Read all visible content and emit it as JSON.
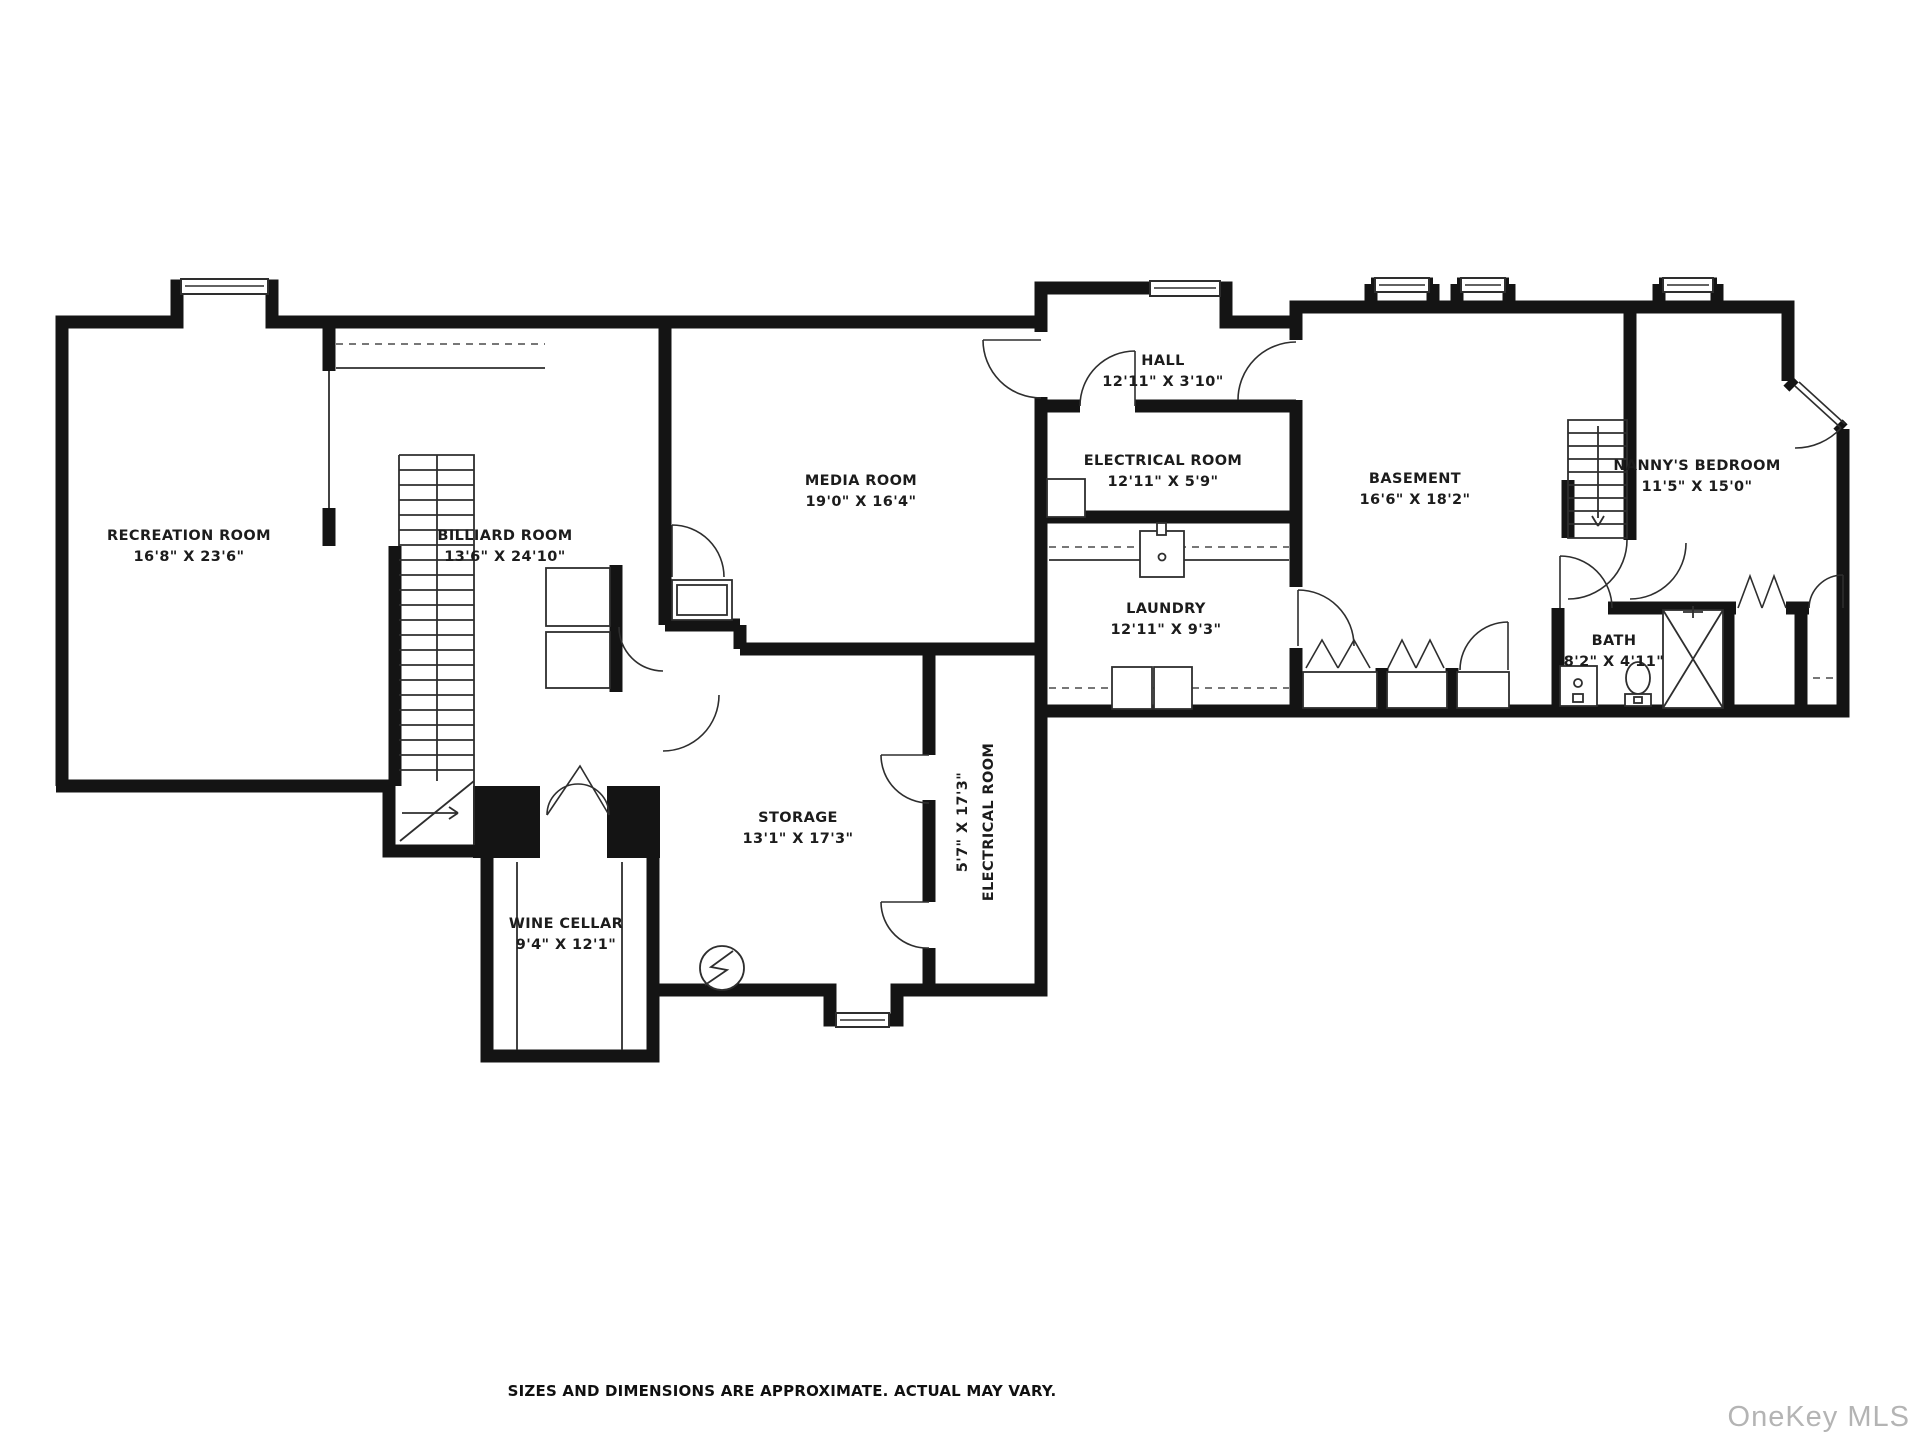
{
  "title": "Basement floor plan",
  "colors": {
    "wall": "#141414",
    "line": "#2e2e2e",
    "bg": "#ffffff",
    "wm": "#b4b4b4"
  },
  "rooms": [
    {
      "id": "recreation-room",
      "name": "RECREATION ROOM",
      "dims": "16'8\" X 23'6\"",
      "cx": 189,
      "cy": 540
    },
    {
      "id": "billiard-room",
      "name": "BILLIARD ROOM",
      "dims": "13'6\" X 24'10\"",
      "cx": 505,
      "cy": 540
    },
    {
      "id": "media-room",
      "name": "MEDIA ROOM",
      "dims": "19'0\" X 16'4\"",
      "cx": 861,
      "cy": 485
    },
    {
      "id": "hall",
      "name": "HALL",
      "dims": "12'11\" X 3'10\"",
      "cx": 1163,
      "cy": 365
    },
    {
      "id": "electrical-room-upper",
      "name": "ELECTRICAL ROOM",
      "dims": "12'11\" X 5'9\"",
      "cx": 1163,
      "cy": 465
    },
    {
      "id": "laundry",
      "name": "LAUNDRY",
      "dims": "12'11\" X 9'3\"",
      "cx": 1166,
      "cy": 613
    },
    {
      "id": "basement",
      "name": "BASEMENT",
      "dims": "16'6\" X 18'2\"",
      "cx": 1415,
      "cy": 483
    },
    {
      "id": "nannys-bedroom",
      "name": "NANNY'S BEDROOM",
      "dims": "11'5\" X 15'0\"",
      "cx": 1697,
      "cy": 470
    },
    {
      "id": "bath",
      "name": "BATH",
      "dims": "8'2\" X 4'11\"",
      "cx": 1614,
      "cy": 645
    },
    {
      "id": "storage",
      "name": "STORAGE",
      "dims": "13'1\" X 17'3\"",
      "cx": 798,
      "cy": 822
    },
    {
      "id": "electrical-room-lower",
      "name": "ELECTRICAL ROOM",
      "dims": "5'7\" X 17'3\"",
      "cx": 980,
      "cy": 822,
      "rotated": true
    },
    {
      "id": "wine-cellar",
      "name": "WINE CELLAR",
      "dims": "9'4\" X 12'1\"",
      "cx": 566,
      "cy": 928
    }
  ],
  "footer": {
    "disclaimer": "SIZES AND DIMENSIONS ARE APPROXIMATE. ACTUAL MAY VARY.",
    "watermark": "OneKey MLS"
  }
}
